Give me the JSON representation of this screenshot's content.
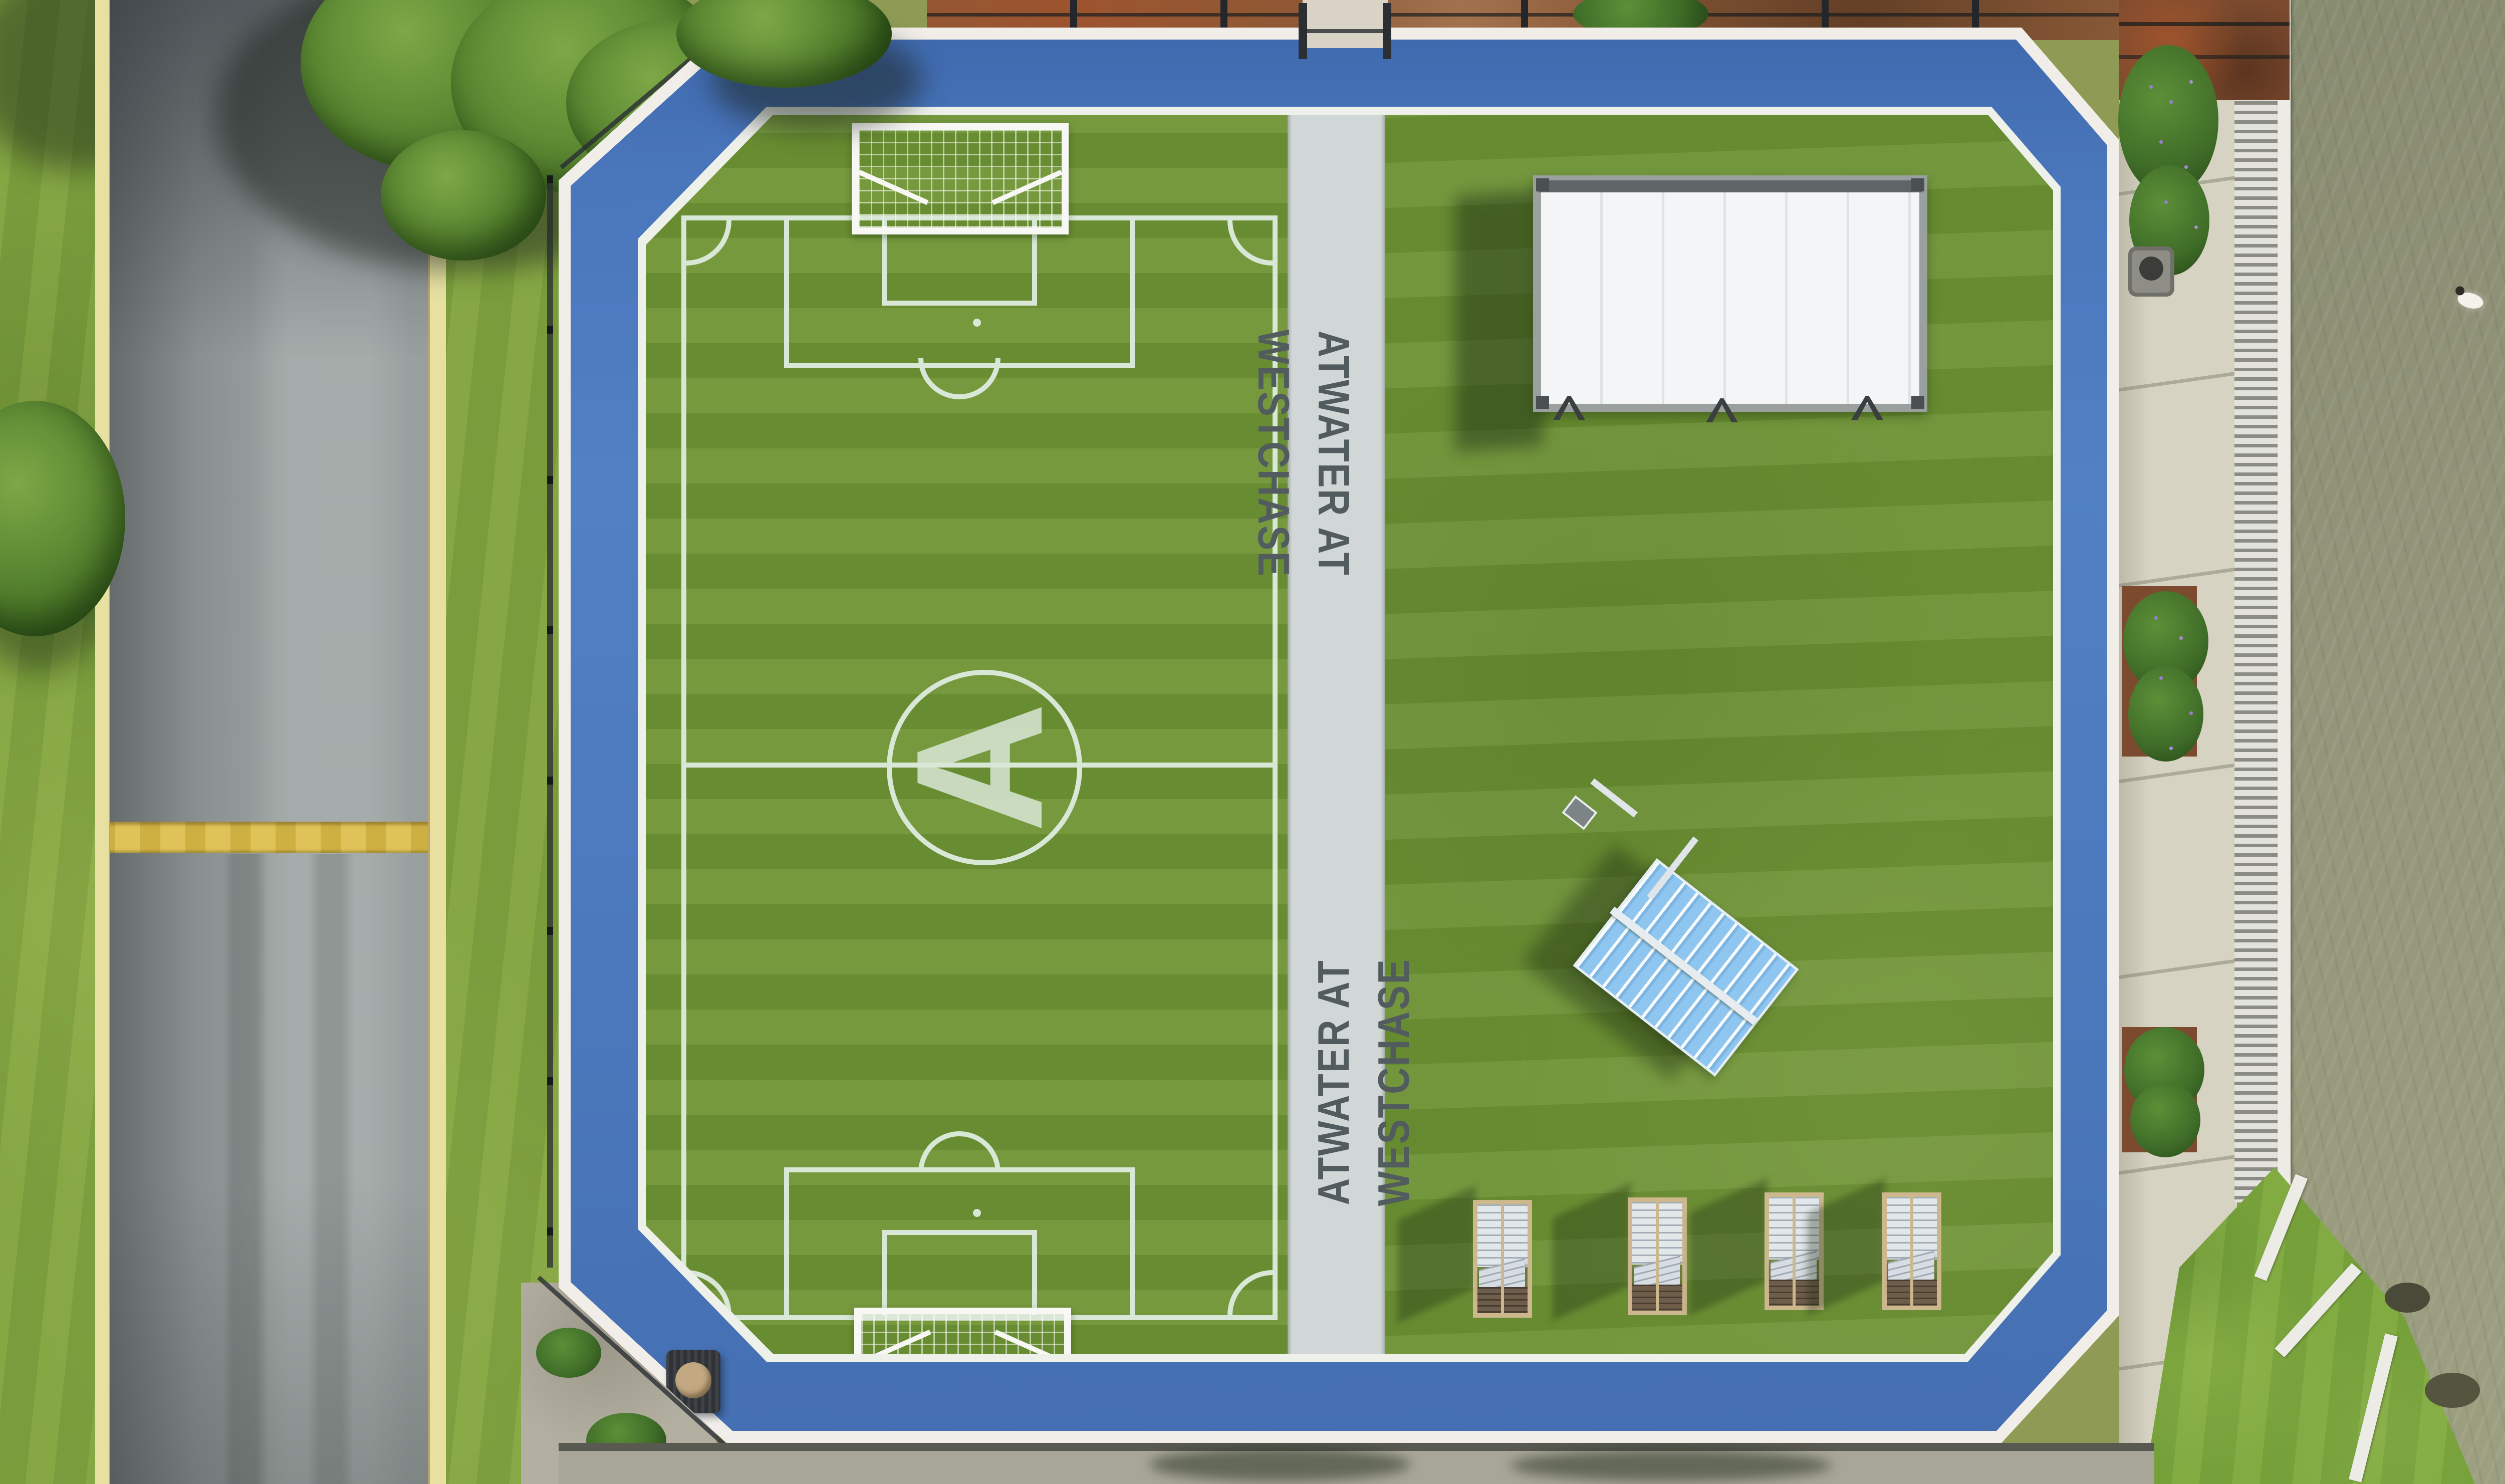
{
  "scene": {
    "description": "Aerial drone view of a community sports park beside a road and a lake",
    "community_name": "ATWATER AT WESTCHASE"
  },
  "walkway": {
    "label_top": "ATWATER AT WESTCHASE",
    "label_bottom": "ATWATER AT WESTCHASE"
  },
  "soccer_field": {
    "center_letter": "A"
  },
  "counts": {
    "walkway_labels": 2,
    "soccer_goals": 2,
    "lounge_chairs": 4,
    "projection_screens": 1,
    "shade_canopies": 1,
    "trash_cans": 2,
    "ducks": 1
  },
  "colors": {
    "track_blue": "#4d7abf",
    "track_edge": "#f1ede8",
    "turf_green": "#6f9434",
    "lawn_green": "#6c9133",
    "field_line": "#d9e7d6",
    "walkway_gray": "#d0d7d6",
    "walkway_text": "#525c5f",
    "road_gray": "#9aa09f",
    "curb_yellow": "#e7e0a0",
    "speed_bump_yellow": "#dcbe4a",
    "grass_green": "#7fa23e",
    "lake_olive": "#8e9175",
    "canopy_blue": "#8fc6ef",
    "screen_white": "#f3f5f6",
    "mulch_rust": "#7c4b2f",
    "concrete": "#d6d3c2",
    "net_white": "#f7f7f4",
    "wood_tan": "#cdb88e"
  }
}
